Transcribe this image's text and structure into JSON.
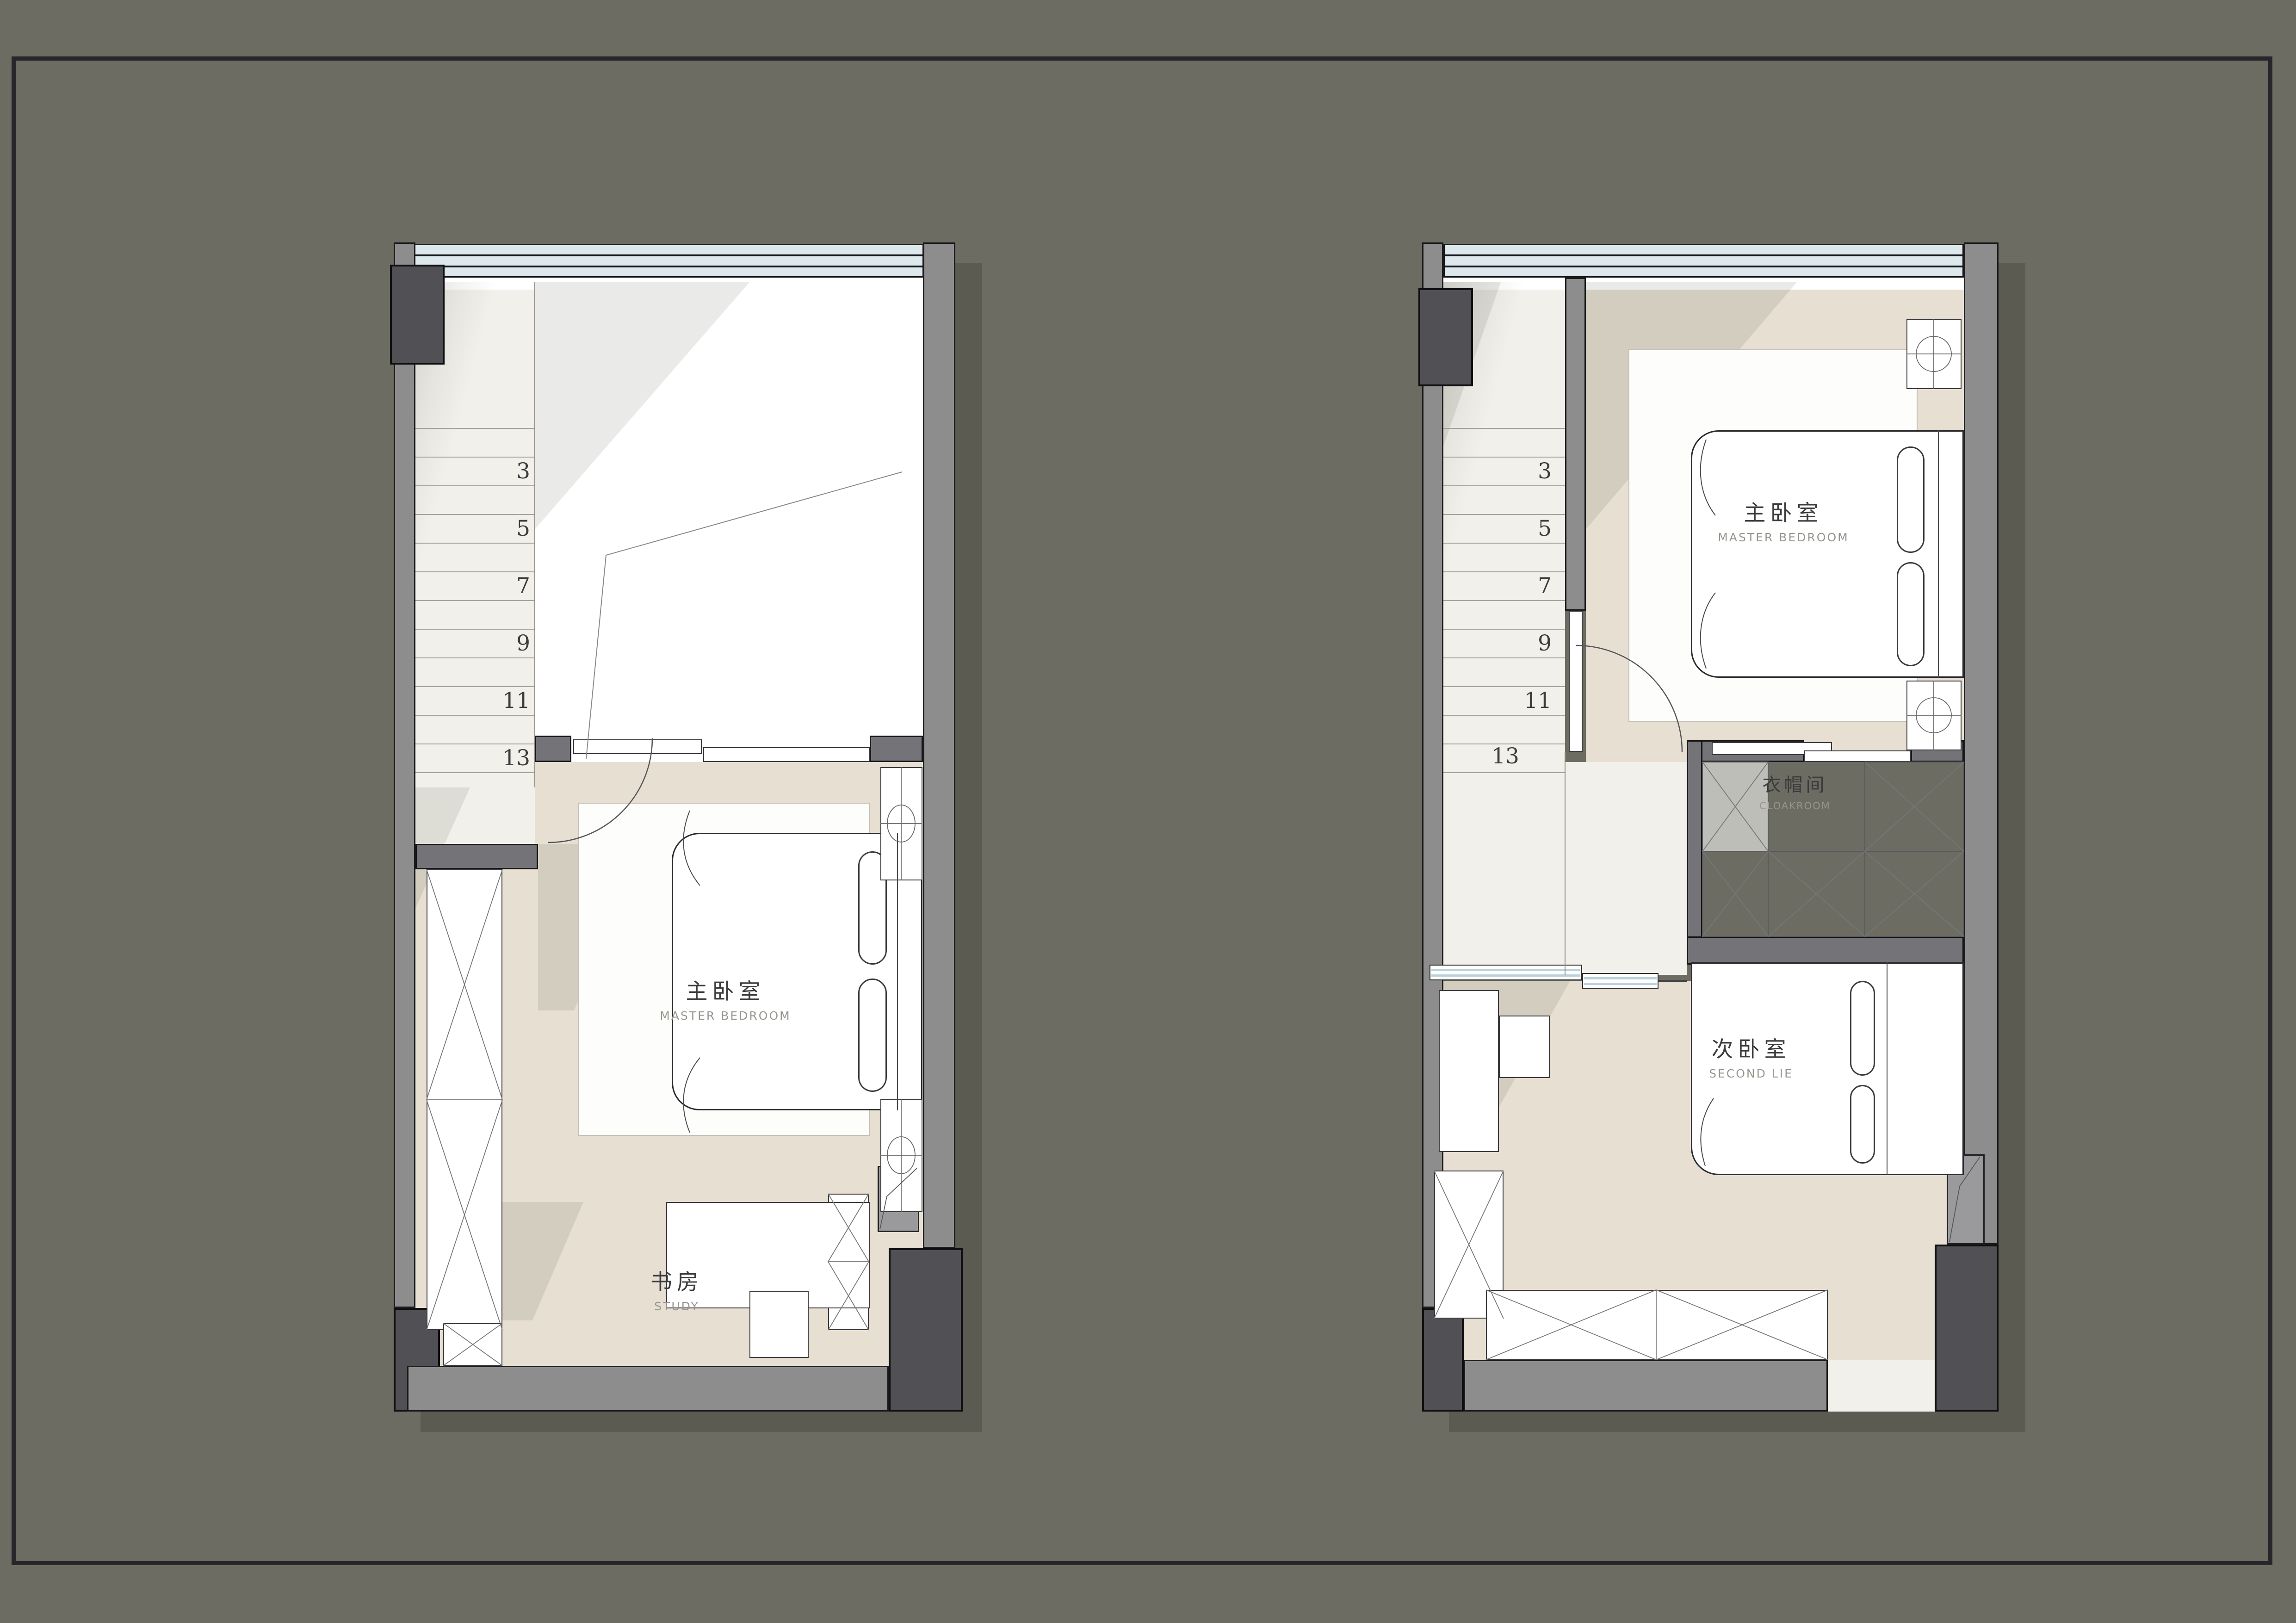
{
  "colors": {
    "background": "#6c6c62",
    "frame": "#26262b",
    "exterior_wall": "#8d8d8d",
    "interior_wall": "#737378",
    "structural_column": "#515155",
    "floor_bedroom": "#e6dfd2",
    "floor_landing": "#f1f0ea",
    "window_glass": "#dce8ec"
  },
  "plan_left": {
    "stair_numbers": [
      "3",
      "5",
      "7",
      "9",
      "11",
      "13"
    ],
    "master_bedroom": {
      "cn": "主卧室",
      "en": "MASTER BEDROOM"
    },
    "study": {
      "cn": "书房",
      "en": "STUDY"
    }
  },
  "plan_right": {
    "stair_numbers": [
      "3",
      "5",
      "7",
      "9",
      "11"
    ],
    "landing_number": "13",
    "master_bedroom": {
      "cn": "主卧室",
      "en": "MASTER BEDROOM"
    },
    "cloakroom": {
      "cn": "衣帽间",
      "en": "CLOAKROOM"
    },
    "second_bedroom": {
      "cn": "次卧室",
      "en": "SECOND LIE"
    }
  }
}
